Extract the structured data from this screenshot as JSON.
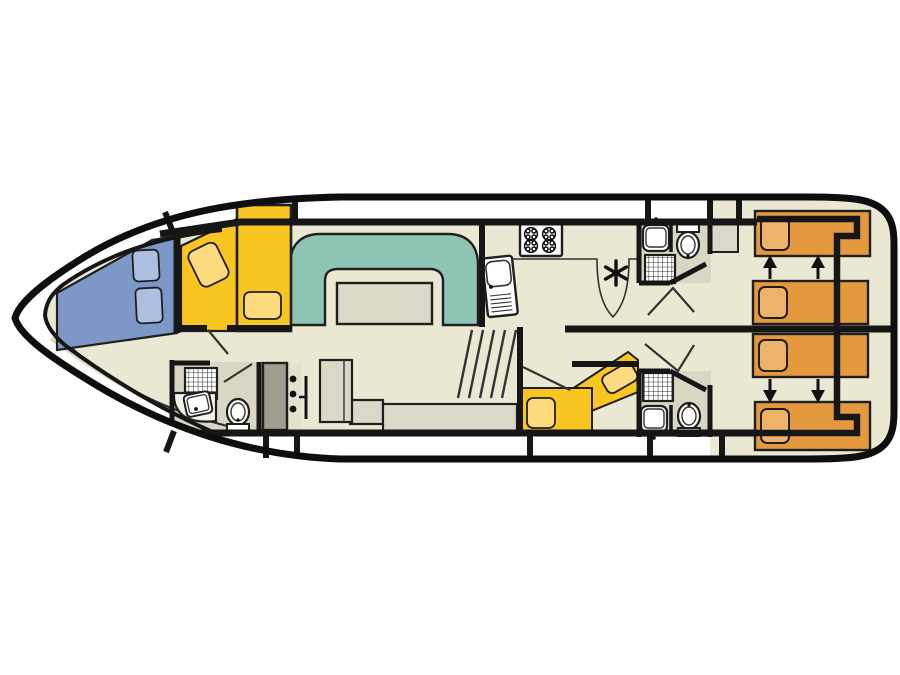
{
  "plan": {
    "kind": "boat-deck-floor-plan",
    "inventory": {
      "bow_cabin": {
        "blue_berth_pillows": 2,
        "yellow_berths": 2
      },
      "salon": {
        "u_sofa": 1,
        "table": 1,
        "bench": 1
      },
      "galley": {
        "stove_burners": 4,
        "sink": 1,
        "heater_symbol": "asterisk"
      },
      "mid_cabin": {
        "yellow_berths": 2
      },
      "stern_cabins": {
        "single_berths": 4,
        "slide_arrows_up": 2,
        "slide_arrows_down": 2
      },
      "bathrooms": {
        "count": 3,
        "toilets": 3,
        "washbasins": 3,
        "showers": 3
      },
      "helm": {
        "instrument_dots": 3
      }
    }
  },
  "colors": {
    "background": "#ffffff",
    "hull": "#0e0e0e",
    "wall": "#161616",
    "floor": "#eae7d3",
    "floor_gray": "#d9d6c3",
    "counter_gray": "#d6d3c0",
    "furniture_gray": "#dbd8c8",
    "cabinet_dark": "#a19e90",
    "helm_strip": "#e3e0cd",
    "sofa_teal": "#8ec4b3",
    "bed_blue": "#7d98c6",
    "pillow_blue": "#adbfe0",
    "bed_yellow": "#f9c520",
    "pillow_yellow": "#fbdb7e",
    "bed_orange": "#e5993f",
    "pillow_orange": "#eeb36b",
    "fixture_white": "#ffffff",
    "fixture_offwhite": "#f4f3ea",
    "symbol_dark": "#111111"
  }
}
